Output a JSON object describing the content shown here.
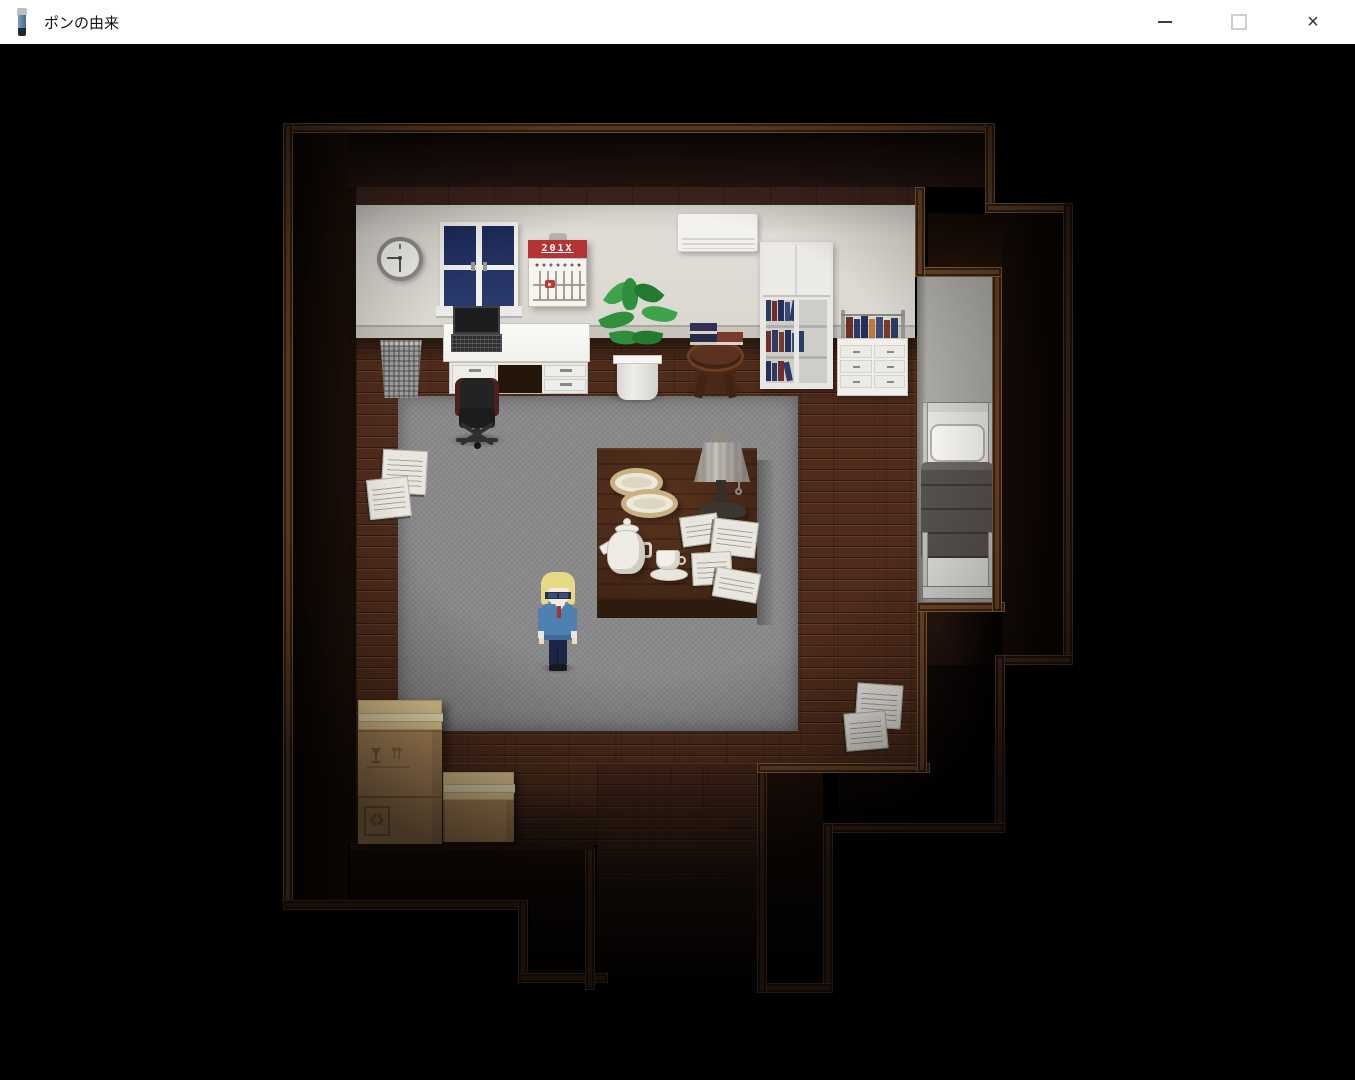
{
  "window": {
    "title": "ポンの由来",
    "app_icon": "flashlight-icon",
    "controls": {
      "minimize_icon": "minimize-icon",
      "maximize_icon": "maximize-icon",
      "close_icon": "close-icon",
      "close_glyph": "×"
    }
  },
  "game": {
    "calendar_header": "201X",
    "box_glyphs": {
      "fragile": "fragile-icon",
      "arrows_up": "⇈",
      "recycle": "♻"
    },
    "colors": {
      "floor_wood": "#4e2b1b",
      "trim_wood": "#6b4629",
      "carpet_gray": "#8a898b",
      "wall_cream": "#dbd8d1",
      "alcove_gray": "#b1afaa",
      "calendar_red": "#b23434",
      "window_pane_navy": "#223061",
      "sweater_blue": "#4e80b2",
      "cardboard": "#ba9162",
      "blanket_gray": "#55514d"
    }
  }
}
